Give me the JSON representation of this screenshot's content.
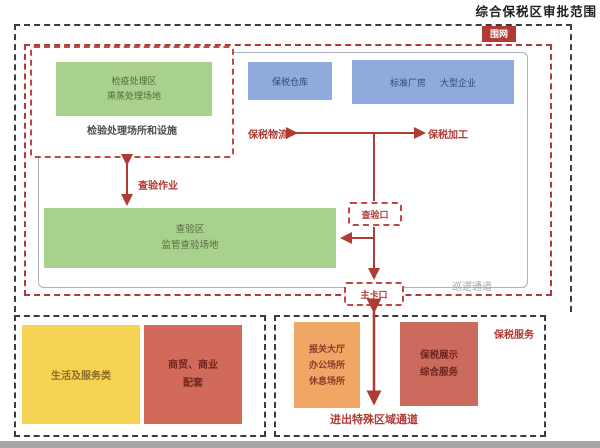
{
  "header": {
    "title": "综合保税区审批范围"
  },
  "fence": {
    "label": "围网"
  },
  "quarantine": {
    "box": {
      "line1": "检疫处理区",
      "line2": "熏蒸处理场地"
    },
    "caption": "检验处理场所和设施"
  },
  "storage": {
    "warehouse": "保税仓库",
    "factory": "标准厂房",
    "enterprise": "大型企业"
  },
  "flows": {
    "logistics": "保税物流",
    "processing": "保税加工",
    "inspection": "查验作业"
  },
  "inspection_area": {
    "line1": "查验区",
    "line2": "监管查验场地"
  },
  "gates": {
    "inspection": "查验口",
    "main": "主卡口"
  },
  "patrol": {
    "label": "巡逻通道"
  },
  "life_zone": {
    "living": "生活及服务类",
    "commerce": {
      "line1": "商贸、商业",
      "line2": "配套"
    }
  },
  "service_zone": {
    "hall": {
      "line1": "报关大厅",
      "line2": "办公场所",
      "line3": "休息场所"
    },
    "display": {
      "line1": "保税展示",
      "line2": "综合服务"
    },
    "label": "保税服务",
    "channel": "进出特殊区域通道"
  },
  "colors": {
    "accent_red": "#b03a34",
    "green": "#a9d18e",
    "blue": "#8faadc",
    "yellow": "#f7d354",
    "salmon": "#d26a5c",
    "orange": "#f0a765",
    "dashed_black": "#3c3c3c",
    "panel_border": "#a9b4bd"
  }
}
